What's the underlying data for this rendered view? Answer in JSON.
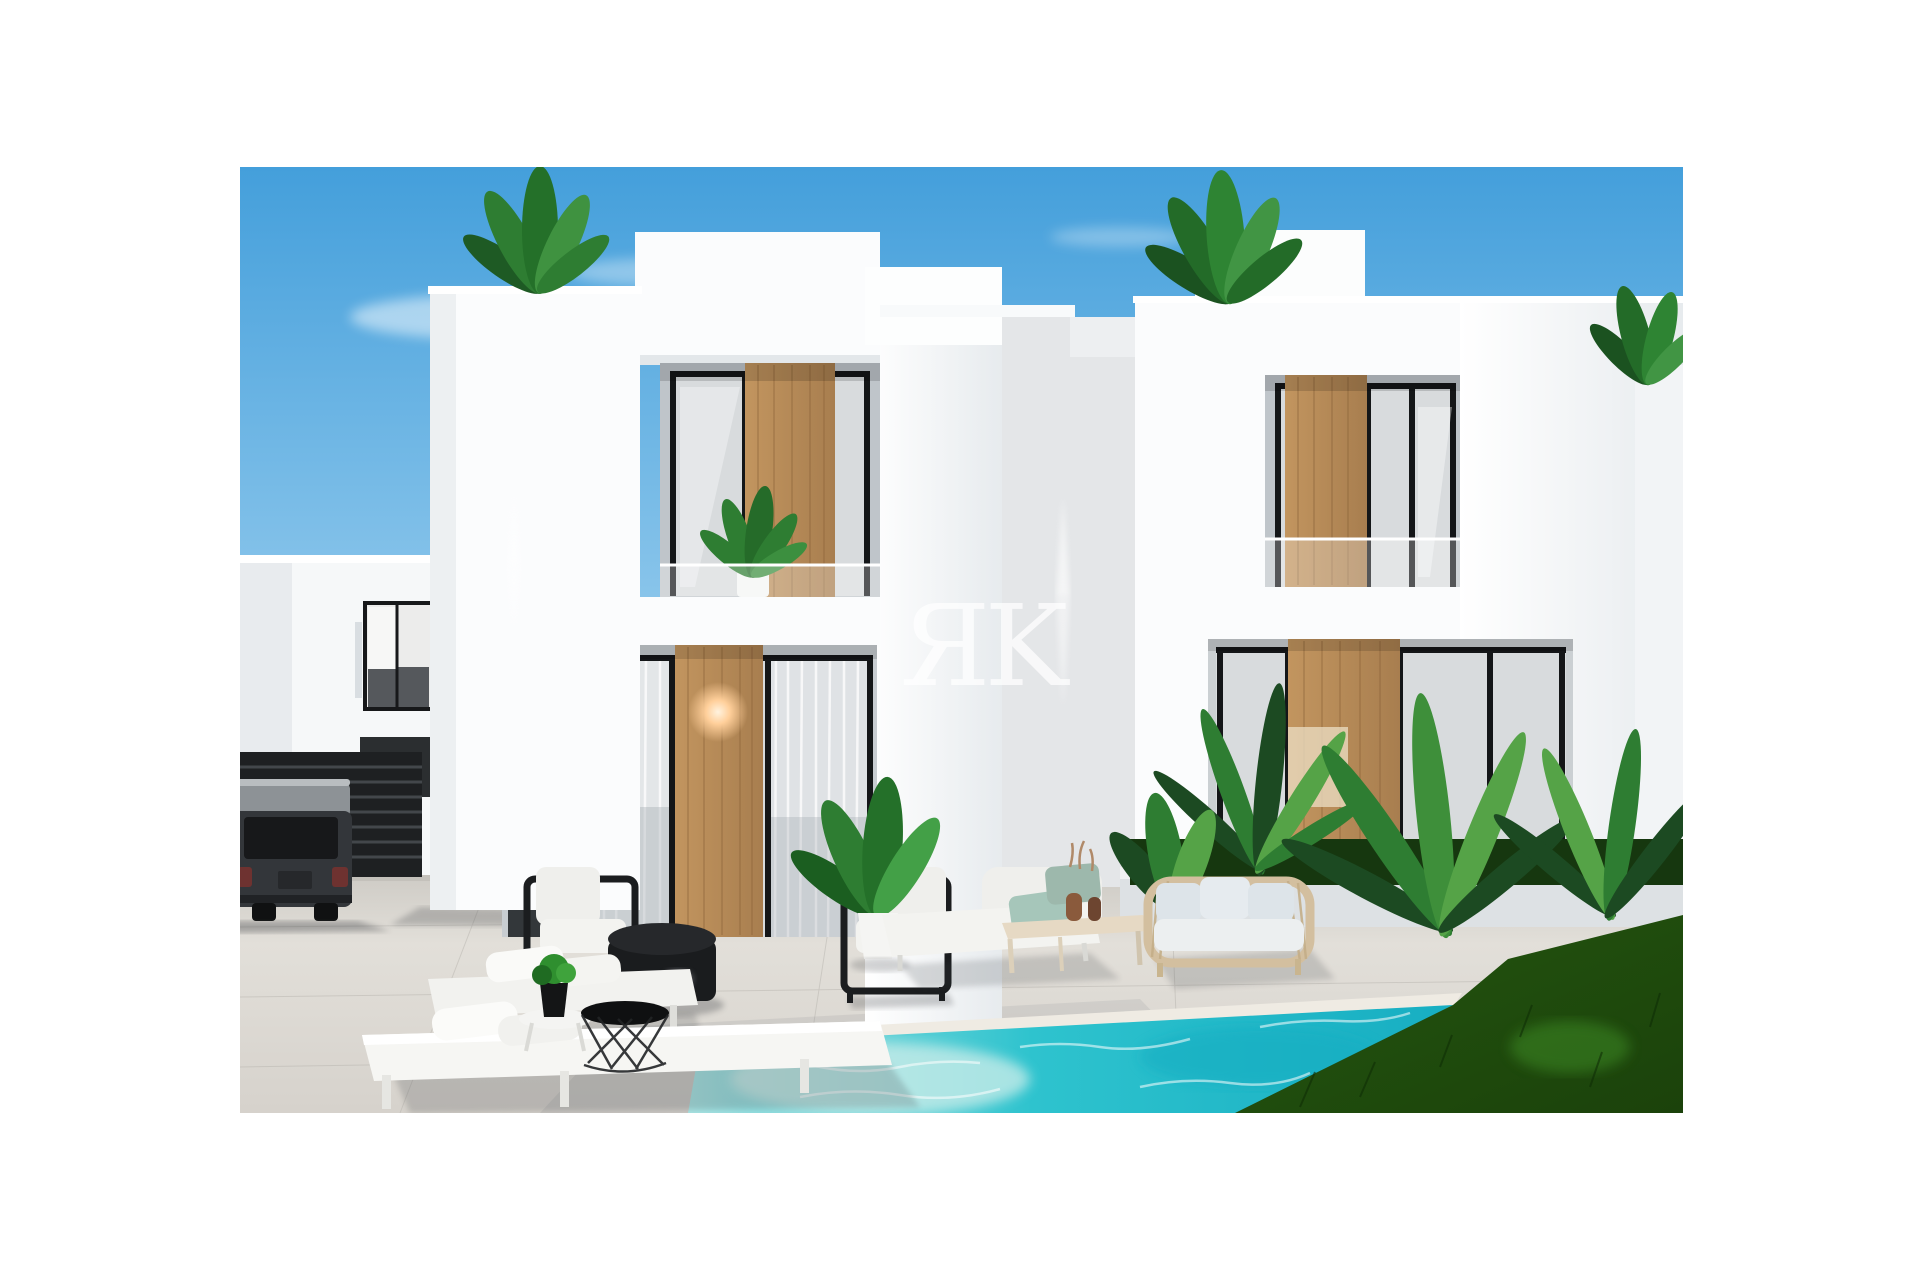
{
  "image": {
    "watermark": "ЯK"
  },
  "colors": {
    "sky_top": "#449FDB",
    "sky_mid": "#8FC8EC",
    "sky_horizon": "#DCEFF9",
    "wall_white": "#FBFCFD",
    "wall_shade": "#E9EDF0",
    "recess_shadow": "#BFC5CA",
    "glass": "#D8DBDD",
    "frame_black": "#141618",
    "wood": "#C2955F",
    "wood_dark": "#A87E4F",
    "paving_far": "#C8C5BF",
    "paving_near": "#E2DFD9",
    "pool_main": "#2EC3CE",
    "pool_light": "#A9E4E3",
    "pool_deep": "#17AEC2",
    "coping": "#EFEBE3",
    "grass_dark": "#24560F",
    "grass_light": "#3F8F28",
    "plant_dark": "#1C4A22",
    "plant_mid": "#2E7D32",
    "plant_light": "#55A347",
    "car_body": "#33363A",
    "car_roof": "#8D9296",
    "gate_dark": "#1E2022",
    "cushion_white": "#F3F3F0",
    "rattan": "#D3BF9F",
    "pillow_blue": "#DDE4E9",
    "pillow_teal": "#A6C6BA",
    "table_wood": "#E6D9C4",
    "glow_warm": "#FFCF9A"
  }
}
